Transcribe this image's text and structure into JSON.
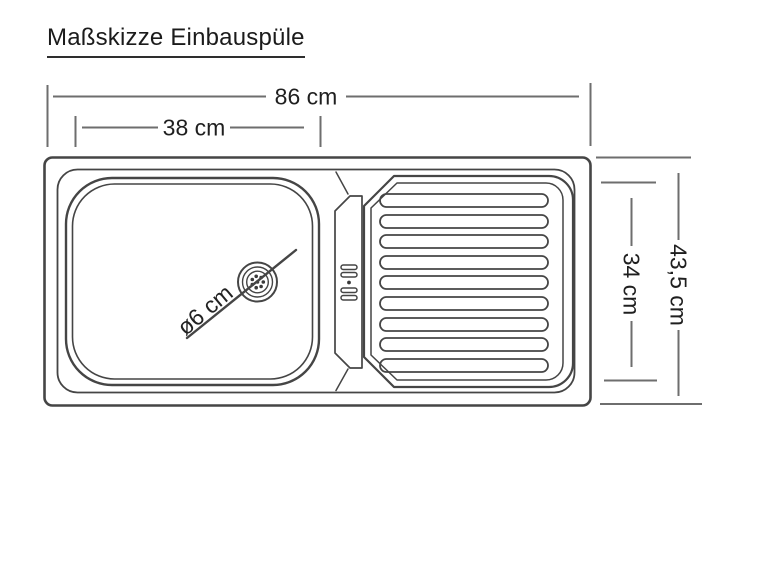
{
  "title": "Maßskizze Einbauspüle",
  "colors": {
    "background": "#ffffff",
    "drawing_line": "#454545",
    "dimension_line": "#6e6e6e",
    "text": "#1f1f1f"
  },
  "dimensions": {
    "total_width_label": "86 cm",
    "basin_width_label": "38 cm",
    "total_depth_label": "43,5 cm",
    "inner_depth_label": "34 cm",
    "drain_diameter_label": "ø6 cm"
  },
  "drawing": {
    "drainer_rib_count": 9
  }
}
